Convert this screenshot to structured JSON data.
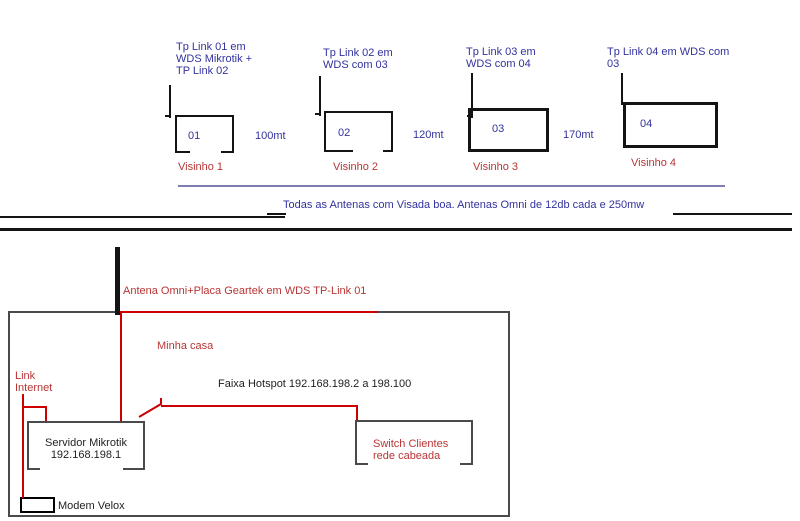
{
  "neighbors": [
    {
      "label_lines": [
        "Tp Link 01 em",
        "WDS Mikrotik +",
        "TP Link 02"
      ],
      "house_number": "01",
      "name": "Visinho 1"
    },
    {
      "label_lines": [
        "Tp Link 02 em",
        "WDS com 03"
      ],
      "house_number": "02",
      "name": "Visinho 2"
    },
    {
      "label_lines": [
        "Tp Link 03 em",
        "WDS com 04"
      ],
      "house_number": "03",
      "name": "Visinho 3"
    },
    {
      "label_lines": [
        "Tp Link 04 em WDS com",
        "03"
      ],
      "house_number": "04",
      "name": "Visinho 4"
    }
  ],
  "distances": [
    "100mt",
    "120mt",
    "170mt"
  ],
  "note": "Todas as Antenas com Visada boa. Antenas Omni de 12db cada e 250mw",
  "my_house": {
    "antenna_label": "Antena Omni+Placa Geartek em WDS TP-Link 01",
    "name": "Minha casa",
    "link_lines": [
      "Link",
      "Internet"
    ],
    "hotspot_label": "Faixa Hotspot 192.168.198.2 a 198.100",
    "server_lines": [
      "Servidor Mikrotik",
      "192.168.198.1"
    ],
    "switch_lines": [
      "Switch Clientes",
      "rede cabeada"
    ],
    "modem_label": "Modem Velox"
  },
  "colors": {
    "blue_text": "#32329e",
    "red_text": "#b83535",
    "red_line": "#cc0000",
    "purple_line": "#7d7daf",
    "black_line": "#141414",
    "box_border": "#4a4a4a"
  }
}
